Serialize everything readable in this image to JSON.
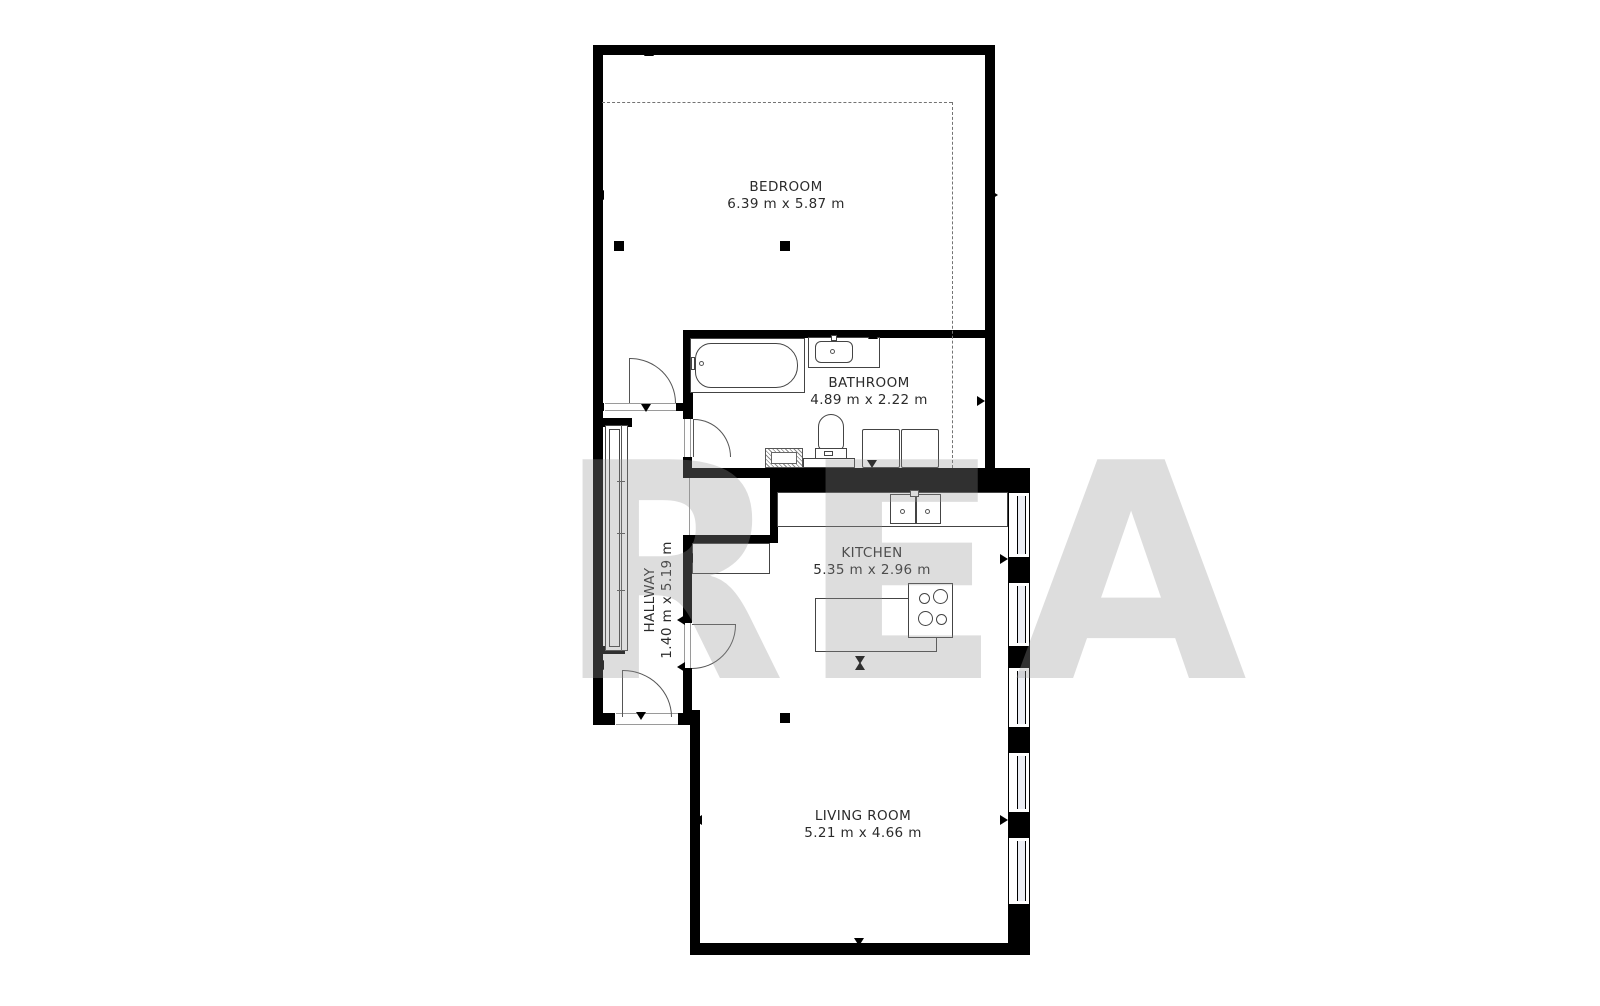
{
  "plan": {
    "rooms": {
      "bedroom": {
        "name": "BEDROOM",
        "dimensions": "6.39 m x 5.87 m"
      },
      "bathroom": {
        "name": "BATHROOM",
        "dimensions": "4.89 m x 2.22 m"
      },
      "kitchen": {
        "name": "KITCHEN",
        "dimensions": "5.35 m x 2.96 m"
      },
      "hallway": {
        "name": "HALLWAY",
        "dimensions": "1.40 m x 5.19 m"
      },
      "living_room": {
        "name": "LIVING ROOM",
        "dimensions": "5.21 m x 4.66 m"
      }
    },
    "watermark": {
      "text": "REA"
    },
    "colors": {
      "wall": "#000000",
      "fixture_outline": "#444444",
      "label_text": "#2b2b2b"
    }
  }
}
